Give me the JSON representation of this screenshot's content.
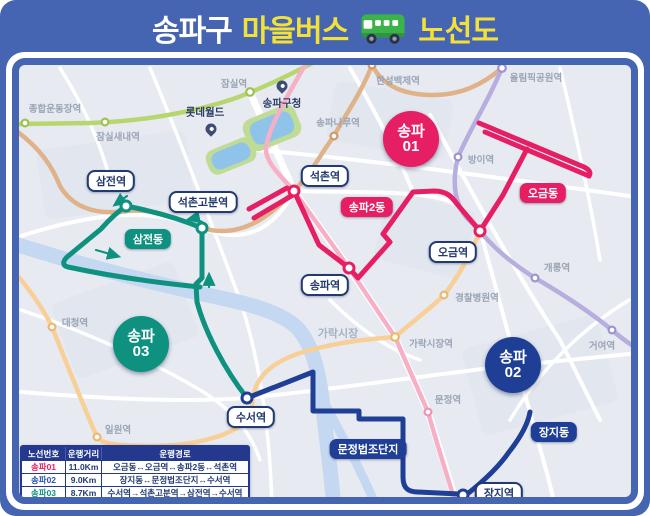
{
  "title": {
    "prefix": "송파구",
    "highlight": "마을버스",
    "suffix": "노선도"
  },
  "colors": {
    "poster_blue": "#4565b2",
    "title_yellow": "#f3e139",
    "route01_crimson": "#e61e63",
    "route02_navy": "#1f3e95",
    "route03_teal": "#0f9180",
    "line2_green": "#b8d670",
    "line8_pink": "#f7afc6",
    "line9_tan": "#dfb28a",
    "line3_orange": "#f8cf97",
    "line5_purple": "#b6aede",
    "river": "#c5d8f1",
    "park": "#bedc96",
    "lake": "#90c3ea",
    "map_bg": "#e7eaf1"
  },
  "map": {
    "metro_stations": [
      {
        "label": "종합운동장역"
      },
      {
        "label": "잠실새내역"
      },
      {
        "label": "잠실역"
      },
      {
        "label": "송파나루역"
      },
      {
        "label": "한성백제역"
      },
      {
        "label": "올림픽공원역"
      },
      {
        "label": "방이역"
      },
      {
        "label": "개롱역"
      },
      {
        "label": "거여역"
      },
      {
        "label": "경찰병원역"
      },
      {
        "label": "가락시장역"
      },
      {
        "label": "문정역"
      },
      {
        "label": "대청역"
      },
      {
        "label": "일원역"
      }
    ],
    "pois": [
      {
        "label": "송파구청"
      },
      {
        "label": "롯데월드"
      }
    ],
    "area_labels": [
      {
        "label": "가락시장"
      }
    ],
    "bus_stops": [
      {
        "label": "삼전역"
      },
      {
        "label": "석촌고분역"
      },
      {
        "label": "석촌역"
      },
      {
        "label": "송파역"
      },
      {
        "label": "오금역"
      },
      {
        "label": "수서역"
      },
      {
        "label": "장지역"
      }
    ],
    "terminus_labels": [
      {
        "label": "삼전동"
      },
      {
        "label": "송파2동"
      },
      {
        "label": "오금동"
      },
      {
        "label": "문정법조단지"
      },
      {
        "label": "장지동"
      }
    ],
    "route_badges": [
      {
        "line1": "송파",
        "line2": "01"
      },
      {
        "line1": "송파",
        "line2": "02"
      },
      {
        "line1": "송파",
        "line2": "03"
      }
    ]
  },
  "table": {
    "headers": [
      "노선번호",
      "운행거리",
      "운행경로"
    ],
    "rows": [
      {
        "route": "송파01",
        "distance": "11.0Km",
        "path": "오금동↔오금역↔송파2동↔석촌역"
      },
      {
        "route": "송파02",
        "distance": "9.0Km",
        "path": "장지동↔문정법조단지↔수서역"
      },
      {
        "route": "송파03",
        "distance": "8.7Km",
        "path": "수서역→석촌고분역→삼전역→수서역"
      }
    ]
  }
}
